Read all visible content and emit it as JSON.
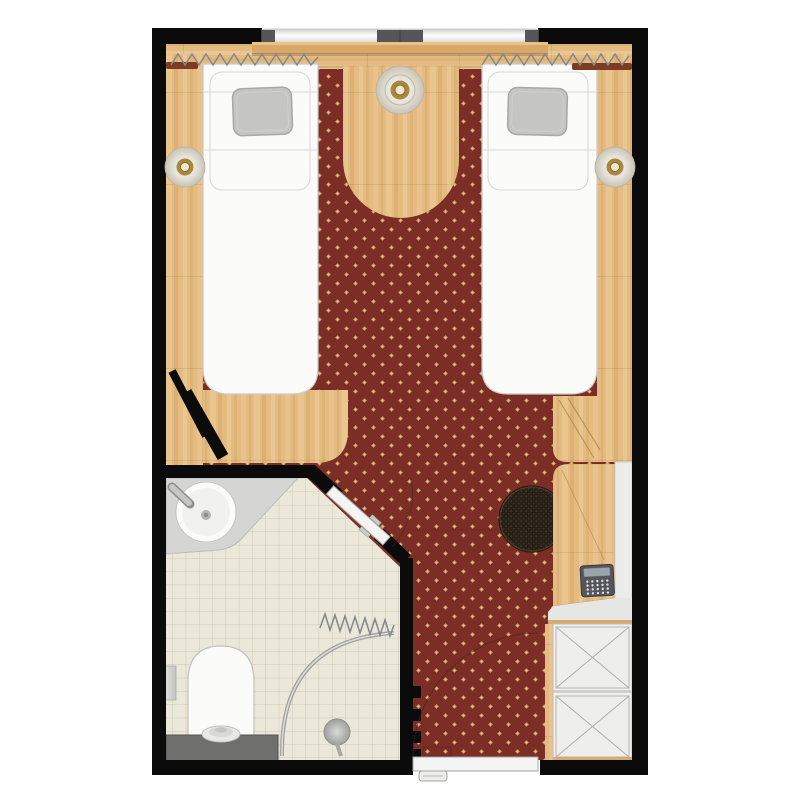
{
  "labels": {
    "plan": "Hotel twin room floor plan",
    "bedroom": "Bedroom with two single beds and red patterned carpet",
    "bathroom": "Bathroom with corner basin, toilet and shower",
    "bed_left": "Single bed left",
    "bed_right": "Single bed right",
    "pillow": "Pillow",
    "window": "Window with three mullions",
    "curtains": "Curtains (zigzag symbol)",
    "headboard_shelf": "Headboard shelf",
    "nightstand": "Bedside table between beds",
    "ceiling_lamp": "Ceiling lamp",
    "wall_lamp_left": "Wall lamp left",
    "wall_lamp_right": "Wall lamp right",
    "wardrobe": "Wardrobe with two crossed panels",
    "desk": "Desk with telephone",
    "telephone": "Telephone",
    "stool": "Stool",
    "luggage_rack": "Luggage rack",
    "entry_door": "Entrance door with swing arc",
    "bathroom_door": "Bathroom door on angled wall",
    "open_door_leaf": "Open door leaf",
    "basin": "Corner basin with tap",
    "toilet": "Toilet with cistern",
    "shower": "Shower with curved curtain rail",
    "shower_curtain": "Shower curtain (zigzag symbol)",
    "niche": "Wall niche",
    "wall_hooks": "Wall hooks",
    "tiles": "Tiled bathroom floor",
    "carpet": "Patterned carpet"
  },
  "palette": {
    "page-bg": "#ffffff",
    "wall": "#0b0b0b",
    "carpet": "#7c2d26",
    "carpet-dot": "#c2955a",
    "carpet-dot-hi": "#e9c98c",
    "wood": "#e4bb80",
    "wood-hi": "#f0d09c",
    "wood-dk": "#d3a364",
    "wood-line": "#a8834e",
    "shelf-wood": "#d9a768",
    "tile": "#ebe8d9",
    "tile-line": "#cdcab7",
    "fixture": "#fbfbf9",
    "fixture-line": "#c2c2c0",
    "counter": "#d5d5d3",
    "cistern": "#6f6f6d",
    "pillow": "#c5c5c3",
    "pillow-line": "#a8a8a6",
    "glass-hi": "#ffffff",
    "glass-lo": "#cfcfcd",
    "mullion": "#54565a",
    "curtain-line": "#83888e",
    "curtain-fabric": "#7c3c24",
    "lamp-gold": "#a8873f",
    "lamp-core": "#f3e9cf",
    "lamp-edge": "#b9b2a2",
    "stool": "#262019",
    "stool-dot": "#4a3a26",
    "phone-body": "#54565b",
    "phone-screen": "#9ba3ad",
    "phone-key": "#dde1e5",
    "wardrobe": "#f0f0ee",
    "panel-line": "#aeaeac",
    "shelf-gray": "#ececea",
    "door-leaf": "#f4f4f2",
    "door-line": "#a5a5a3",
    "swing-arc": "rgba(70,35,28,0.5)"
  },
  "pattern_metrics": {
    "carpet_dot_spacing_px": 18,
    "tile_size_px": 13.3
  }
}
